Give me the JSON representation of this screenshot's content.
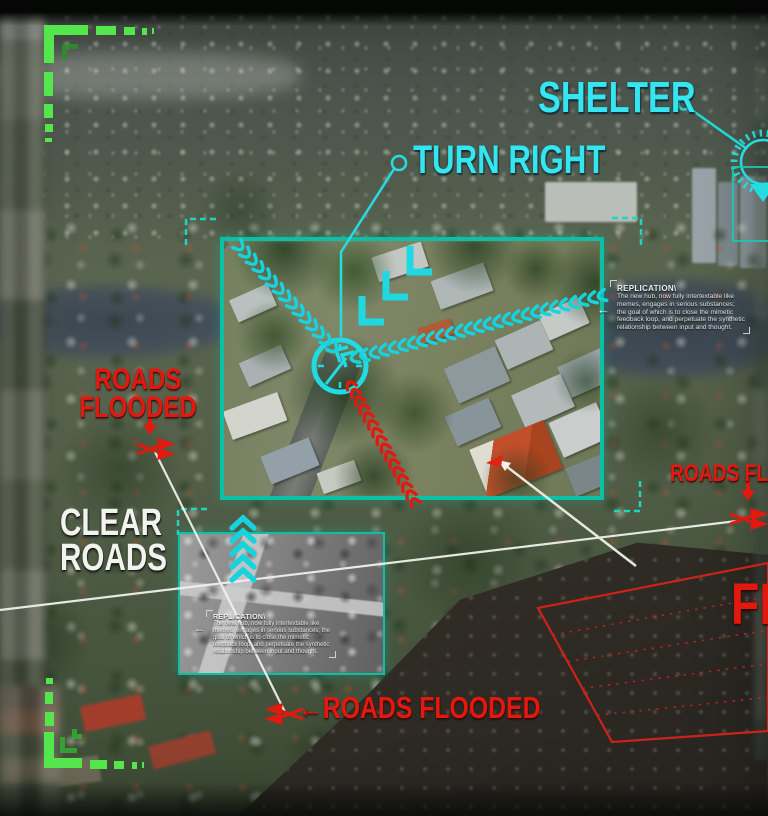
{
  "scene": {
    "type": "aerial-flood-navigation-hud"
  },
  "colors": {
    "cyan": "#35e6f0",
    "teal": "#0cc0a6",
    "red": "#e3180f",
    "green": "#54e64c",
    "white": "#f2f3ef"
  },
  "callouts": {
    "shelter": "SHELTER",
    "turn_right": "TURN RIGHT",
    "roads_flooded_left": {
      "line1": "ROADS",
      "line2": "FLOODED"
    },
    "clear_roads": {
      "line1": "CLEAR",
      "line2": "ROADS"
    },
    "roads_flooded_bottom": {
      "arrow": "←",
      "text": "ROADS FLOODED"
    },
    "roads_flooded_right": "ROADS FLOODED",
    "flood_zone_label": "FLOODED"
  },
  "panels": {
    "right": {
      "title": "REPLICATION\\",
      "body": "The new hub, now fully intertextable like memes, engages in serious substances; the goal of which is to close the mimetic feedback loop, and perpetuate the synthetic relationship between input and thought.",
      "arrow": "←"
    },
    "inset": {
      "title": "REPLICATION\\",
      "body": "The new hub, now fully intertextable like memes, engages in serious substances; the goal of which is to close the mimetic feedback loop, and perpetuate the synthetic relationship between input and thought.",
      "arrow": "←"
    }
  }
}
